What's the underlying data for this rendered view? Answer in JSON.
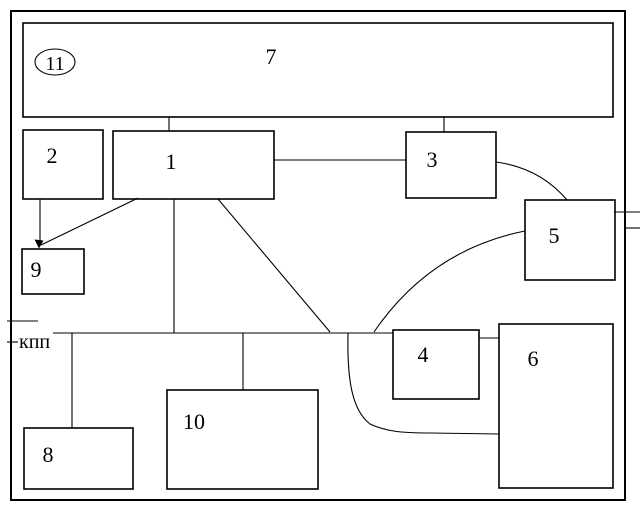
{
  "canvas": {
    "background": "#ffffff",
    "line_color": "#000000"
  },
  "blocks": {
    "b1": {
      "label": "1",
      "shape": "rect"
    },
    "b2": {
      "label": "2",
      "shape": "rect"
    },
    "b3": {
      "label": "3",
      "shape": "rect"
    },
    "b4": {
      "label": "4",
      "shape": "rect"
    },
    "b5": {
      "label": "5",
      "shape": "rect"
    },
    "b6": {
      "label": "6",
      "shape": "rect"
    },
    "b7": {
      "label": "7",
      "shape": "rect"
    },
    "b8": {
      "label": "8",
      "shape": "rect"
    },
    "b9": {
      "label": "9",
      "shape": "rect"
    },
    "b10": {
      "label": "10",
      "shape": "rect"
    },
    "b11": {
      "label": "11",
      "shape": "ellipse"
    }
  },
  "annotations": {
    "kpp_label": "кпп"
  },
  "edges": [
    {
      "from": "7",
      "to": "1",
      "style": "line"
    },
    {
      "from": "7",
      "to": "3",
      "style": "line"
    },
    {
      "from": "1",
      "to": "3",
      "style": "line"
    },
    {
      "from": "3",
      "to": "5",
      "style": "curve"
    },
    {
      "from": "2",
      "to": "9",
      "style": "arrow"
    },
    {
      "from": "1",
      "to": "9",
      "style": "arrow"
    },
    {
      "from": "1",
      "to": "bus",
      "style": "line"
    },
    {
      "from": "1",
      "to": "bus",
      "style": "diagonal"
    },
    {
      "from": "5",
      "to": "bus",
      "style": "curve"
    },
    {
      "from": "bus",
      "to": "4",
      "style": "line"
    },
    {
      "from": "bus",
      "to": "8",
      "style": "line"
    },
    {
      "from": "bus",
      "to": "10",
      "style": "line"
    },
    {
      "from": "bus",
      "to": "6",
      "style": "curve"
    },
    {
      "from": "4",
      "to": "6",
      "style": "line"
    },
    {
      "from": "kpp",
      "to": "external-left",
      "style": "ticks"
    },
    {
      "from": "5",
      "to": "external-right",
      "style": "ticks"
    }
  ]
}
